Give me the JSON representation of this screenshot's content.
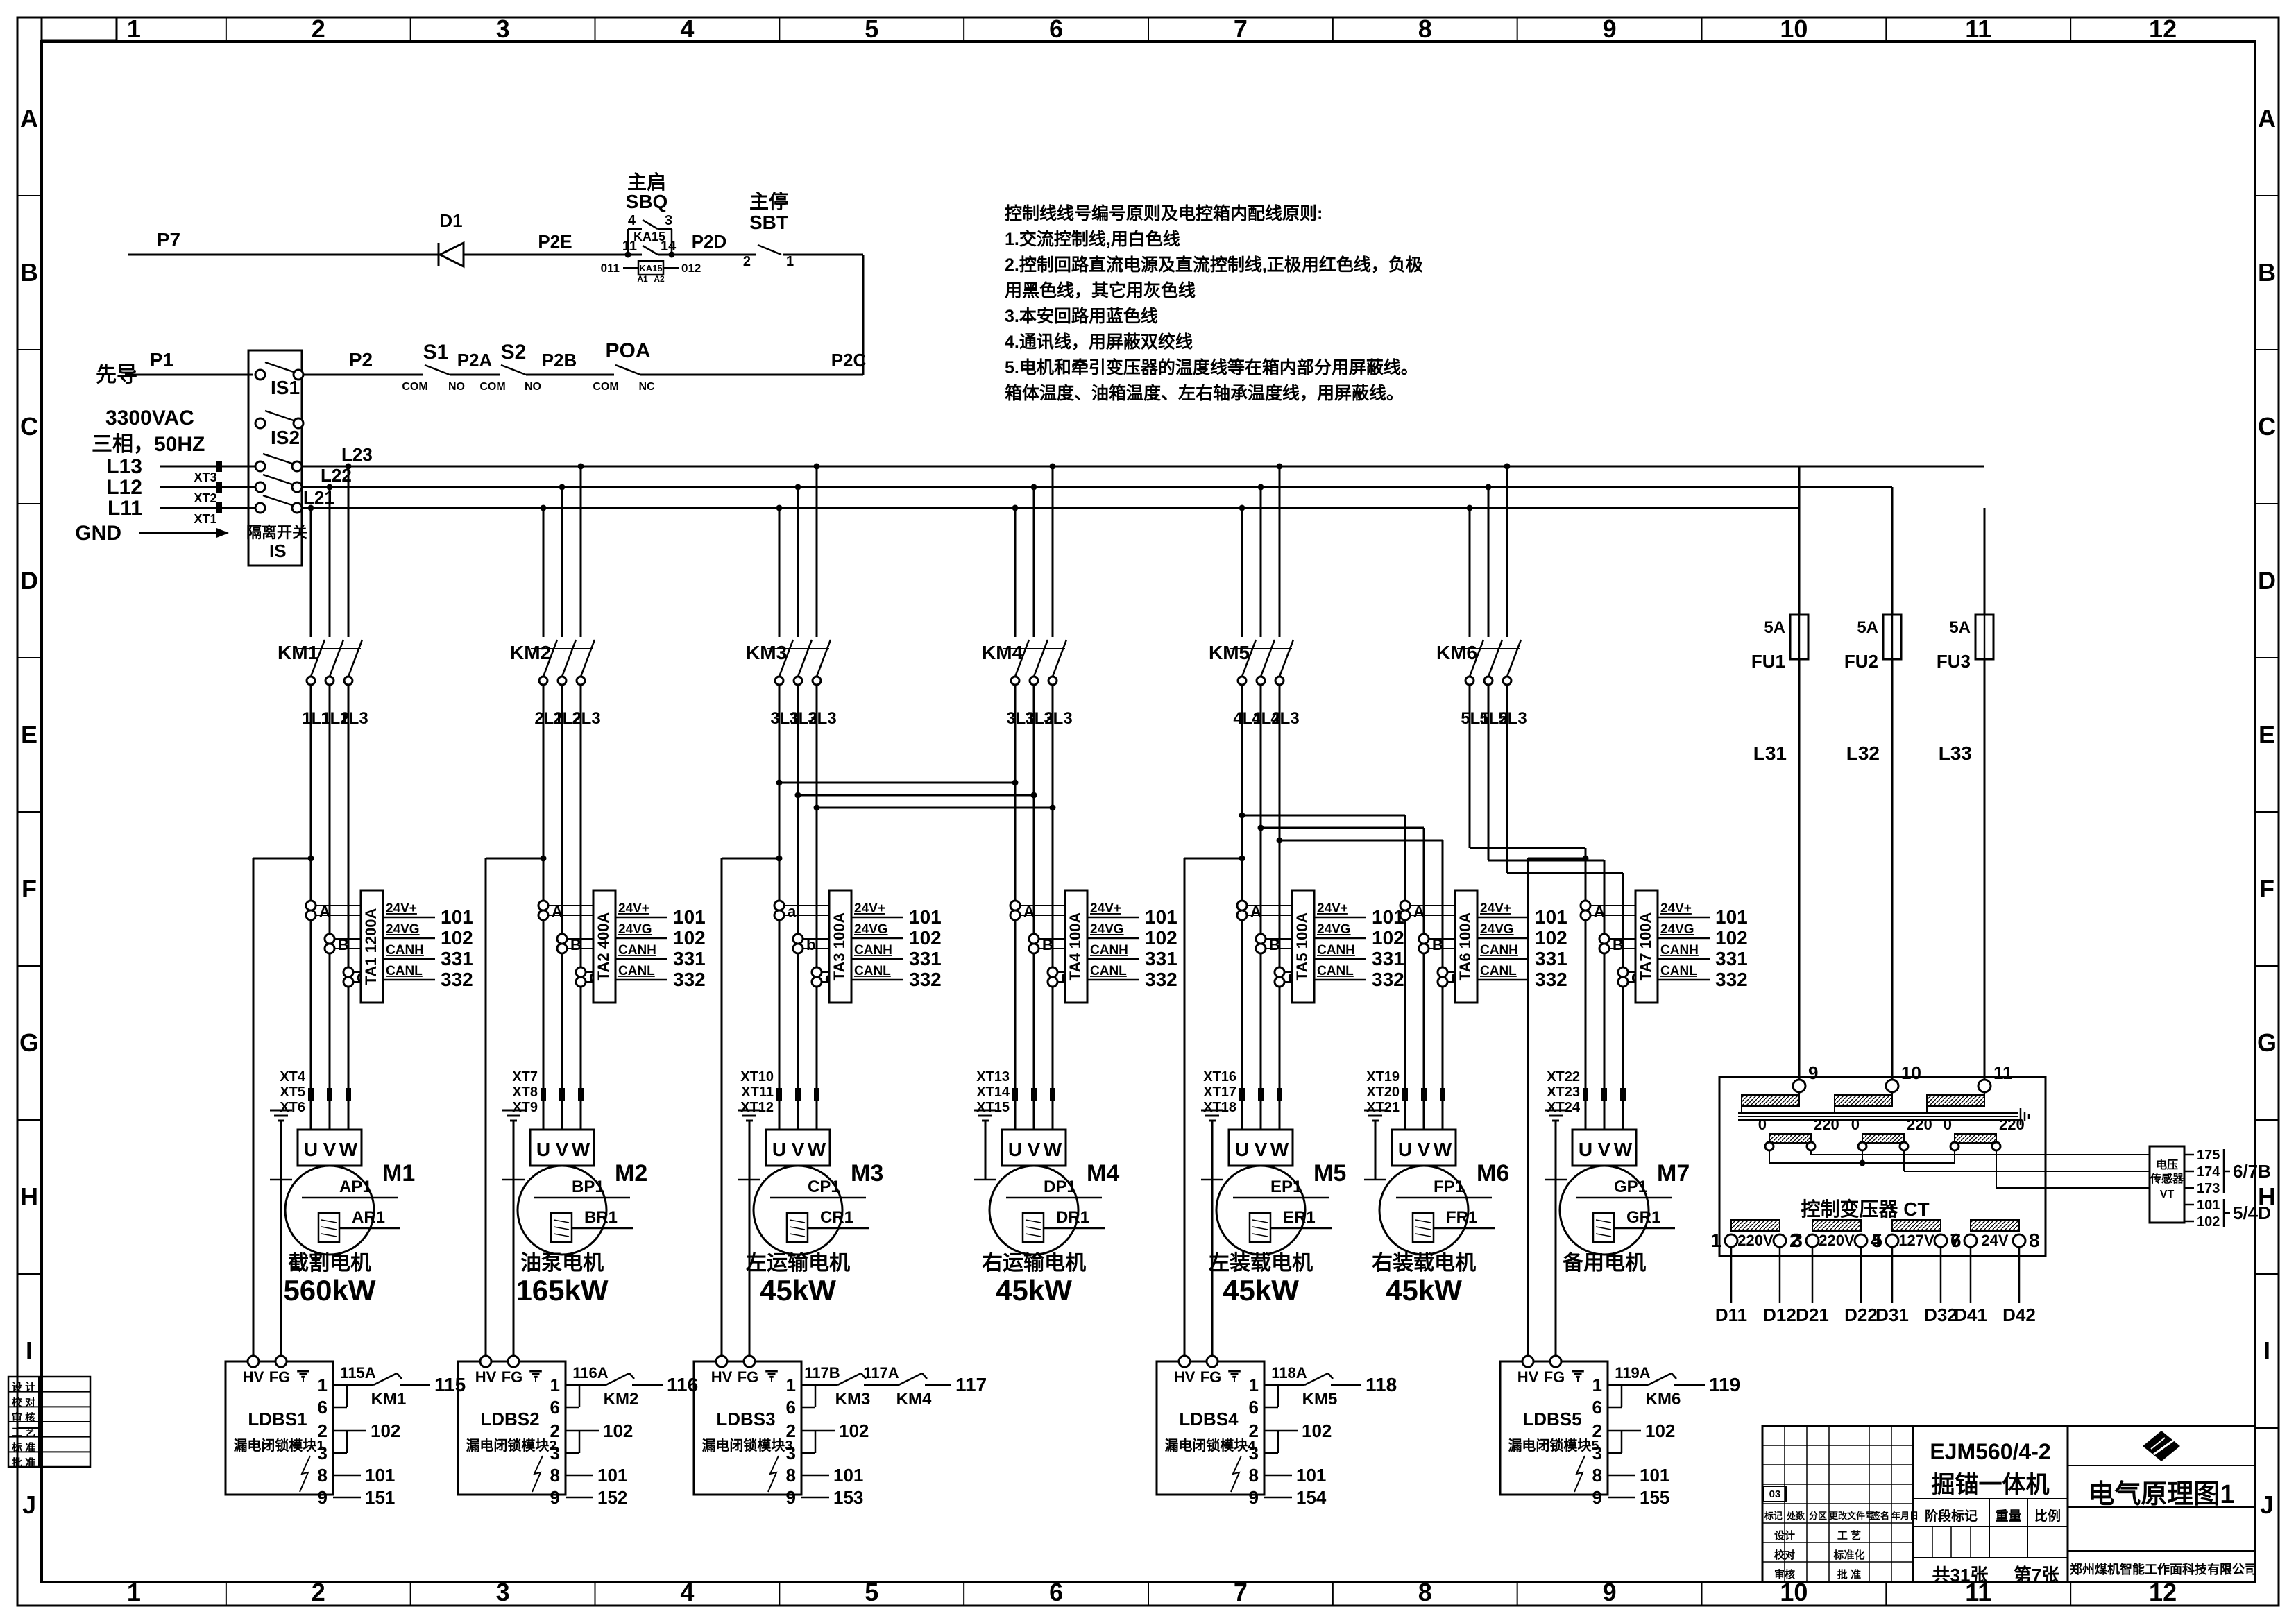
{
  "frame": {
    "columns": [
      "1",
      "2",
      "3",
      "4",
      "5",
      "6",
      "7",
      "8",
      "9",
      "10",
      "11",
      "12"
    ],
    "rows": [
      "A",
      "B",
      "C",
      "D",
      "E",
      "F",
      "G",
      "H",
      "I",
      "J"
    ]
  },
  "notes": {
    "lines": [
      "控制线线号编号原则及电控箱内配线原则:",
      "1.交流控制线,用白色线",
      "2.控制回路直流电源及直流控制线,正极用红色线，负极",
      "用黑色线，其它用灰色线",
      "3.本安回路用蓝色线",
      "4.通讯线，用屏蔽双绞线",
      "5.电机和牵引变压器的温度线等在箱内部分用屏蔽线。",
      "箱体温度、油箱温度、左右轴承温度线，用屏蔽线。"
    ]
  },
  "control": {
    "p7": "P7",
    "d1": "D1",
    "p2e": "P2E",
    "sbq_name": "主启",
    "sbq": "SBQ",
    "sbq_pin4": "4",
    "sbq_pin3": "3",
    "ka15": "KA15",
    "ka15_pin11": "11",
    "ka15_pin14": "14",
    "coil": "KA15",
    "w011": "011",
    "w012": "012",
    "a1": "A1",
    "a2": "A2",
    "p2d": "P2D",
    "sbt_name": "主停",
    "sbt": "SBT",
    "sbt_pin2": "2",
    "sbt_pin1": "1",
    "p2c": "P2C"
  },
  "pilot": {
    "name": "先导",
    "p1": "P1",
    "p2": "P2",
    "s1": "S1",
    "s2": "S2",
    "poa": "POA",
    "com": "COM",
    "no": "NO",
    "nc": "NC",
    "p2a": "P2A",
    "p2b": "P2B"
  },
  "incoming": {
    "voltage": "3300VAC",
    "phase": "三相，50HZ",
    "gnd": "GND",
    "lines": [
      {
        "label": "L13",
        "xt": "XT3"
      },
      {
        "label": "L12",
        "xt": "XT2"
      },
      {
        "label": "L11",
        "xt": "XT1"
      }
    ],
    "switch_name": "隔离开关",
    "switch_id": "IS",
    "pole1": "IS1",
    "pole2": "IS2"
  },
  "bus": [
    "L23",
    "L22",
    "L21"
  ],
  "fuses": [
    {
      "id": "FU1",
      "rating": "5A",
      "wire": "L31"
    },
    {
      "id": "FU2",
      "rating": "5A",
      "wire": "L32"
    },
    {
      "id": "FU3",
      "rating": "5A",
      "wire": "L33"
    }
  ],
  "contactors": [
    {
      "id": "KM1",
      "wires": [
        "1L1",
        "1L2",
        "1L3"
      ]
    },
    {
      "id": "KM2",
      "wires": [
        "2L1",
        "2L2",
        "2L3"
      ]
    },
    {
      "id": "KM3",
      "wires": [
        "3L1",
        "3L2",
        "3L3"
      ]
    },
    {
      "id": "KM4",
      "wires": [
        "3L1",
        "3L2",
        "3L3"
      ]
    },
    {
      "id": "KM5",
      "wires": [
        "4L1",
        "4L2",
        "4L3"
      ]
    },
    {
      "id": "KM6",
      "wires": [
        "5L1",
        "5L2",
        "5L3"
      ]
    }
  ],
  "ta_pins": {
    "labels": [
      "24V+",
      "24VG",
      "CANH",
      "CANL"
    ],
    "wires": [
      "101",
      "102",
      "331",
      "332"
    ]
  },
  "motor_terminals": [
    "U",
    "V",
    "W"
  ],
  "motors": [
    {
      "id": "M1",
      "ta": "TA1 1200A",
      "ct": [
        "A",
        "B",
        "C"
      ],
      "xt": [
        "XT4",
        "XT5",
        "XT6"
      ],
      "p": "AP1",
      "r": "AR1",
      "name": "截割电机",
      "power": "560kW"
    },
    {
      "id": "M2",
      "ta": "TA2 400A",
      "ct": [
        "A",
        "B",
        "C"
      ],
      "xt": [
        "XT7",
        "XT8",
        "XT9"
      ],
      "p": "BP1",
      "r": "BR1",
      "name": "油泵电机",
      "power": "165kW"
    },
    {
      "id": "M3",
      "ta": "TA3 100A",
      "ct": [
        "a",
        "b",
        "c"
      ],
      "xt": [
        "XT10",
        "XT11",
        "XT12"
      ],
      "p": "CP1",
      "r": "CR1",
      "name": "左运输电机",
      "power": "45kW"
    },
    {
      "id": "M4",
      "ta": "TA4 100A",
      "ct": [
        "A",
        "B",
        "C"
      ],
      "xt": [
        "XT13",
        "XT14",
        "XT15"
      ],
      "p": "DP1",
      "r": "DR1",
      "name": "右运输电机",
      "power": "45kW"
    },
    {
      "id": "M5",
      "ta": "TA5 100A",
      "ct": [
        "A",
        "B",
        "C"
      ],
      "xt": [
        "XT16",
        "XT17",
        "XT18"
      ],
      "p": "EP1",
      "r": "ER1",
      "name": "左装载电机",
      "power": "45kW"
    },
    {
      "id": "M6",
      "ta": "TA6 100A",
      "ct": [
        "A",
        "B",
        "C"
      ],
      "xt": [
        "XT19",
        "XT20",
        "XT21"
      ],
      "p": "FP1",
      "r": "FR1",
      "name": "右装载电机",
      "power": "45kW"
    },
    {
      "id": "M7",
      "ta": "TA7 100A",
      "ct": [
        "A",
        "B",
        "C"
      ],
      "xt": [
        "XT22",
        "XT23",
        "XT24"
      ],
      "p": "GP1",
      "r": "GR1",
      "name": "备用电机",
      "power": ""
    }
  ],
  "ldbs": [
    {
      "id": "LDBS1",
      "name": "漏电闭锁模块1",
      "hv": "HV",
      "fg": "FG",
      "pins": [
        "1",
        "6",
        "2",
        "3",
        "8",
        "9"
      ],
      "chain": [
        "115A",
        "KM1",
        "115"
      ],
      "w23": "102",
      "w8": "101",
      "w9": "151"
    },
    {
      "id": "LDBS2",
      "name": "漏电闭锁模块2",
      "hv": "HV",
      "fg": "FG",
      "pins": [
        "1",
        "6",
        "2",
        "3",
        "8",
        "9"
      ],
      "chain": [
        "116A",
        "KM2",
        "116"
      ],
      "w23": "102",
      "w8": "101",
      "w9": "152"
    },
    {
      "id": "LDBS3",
      "name": "漏电闭锁模块3",
      "hv": "HV",
      "fg": "FG",
      "pins": [
        "1",
        "6",
        "2",
        "3",
        "8",
        "9"
      ],
      "chain": [
        "117B",
        "KM3",
        "117A",
        "KM4",
        "117"
      ],
      "w23": "102",
      "w8": "101",
      "w9": "153"
    },
    {
      "id": "LDBS4",
      "name": "漏电闭锁模块4",
      "hv": "HV",
      "fg": "FG",
      "pins": [
        "1",
        "6",
        "2",
        "3",
        "8",
        "9"
      ],
      "chain": [
        "118A",
        "KM5",
        "118"
      ],
      "w23": "102",
      "w8": "101",
      "w9": "154"
    },
    {
      "id": "LDBS5",
      "name": "漏电闭锁模块5",
      "hv": "HV",
      "fg": "FG",
      "pins": [
        "1",
        "6",
        "2",
        "3",
        "8",
        "9"
      ],
      "chain": [
        "119A",
        "KM6",
        "119"
      ],
      "w23": "102",
      "w8": "101",
      "w9": "155"
    }
  ],
  "transformer": {
    "label": "控制变压器  CT",
    "primary": [
      "9",
      "10",
      "11"
    ],
    "tap0": "0",
    "tap220": "220",
    "outputs": [
      {
        "n1": "1",
        "n2": "2",
        "v": "220V",
        "w1": "D11",
        "w2": "D12"
      },
      {
        "n1": "3",
        "n2": "4",
        "v": "220V",
        "w1": "D21",
        "w2": "D22"
      },
      {
        "n1": "5",
        "n2": "6",
        "v": "127V",
        "w1": "D31",
        "w2": "D32"
      },
      {
        "n1": "7",
        "n2": "8",
        "v": "24V",
        "w1": "D41",
        "w2": "D42"
      }
    ]
  },
  "vt": {
    "l1": "电压",
    "l2": "传感器",
    "l3": "VT",
    "pins": [
      "175",
      "174",
      "173",
      "101",
      "102"
    ],
    "group1": "6/7B",
    "group2": "5/4D"
  },
  "titleblock": {
    "model": "EJM560/4-2",
    "product": "掘锚一体机",
    "drawing": "电气原理图1",
    "company": "郑州煤机智能工作面科技有限公司",
    "sheets": "共31张",
    "sheet_no": "第7张",
    "stage": "阶段标记",
    "weight": "重量",
    "scale": "比例",
    "mark": "03",
    "hdr1": "标记",
    "hdr2": "处数",
    "hdr3": "分区",
    "hdr4": "更改文件号",
    "hdr5": "签名",
    "hdr6": "年月日",
    "r1a": "设计",
    "r1b": "工 艺",
    "r2a": "校对",
    "r2b": "标准化",
    "r3a": "审核",
    "r3b": "批 准"
  },
  "side_table": [
    "设 计",
    "校 对",
    "审 核",
    "工 艺",
    "标 准",
    "批 准"
  ]
}
